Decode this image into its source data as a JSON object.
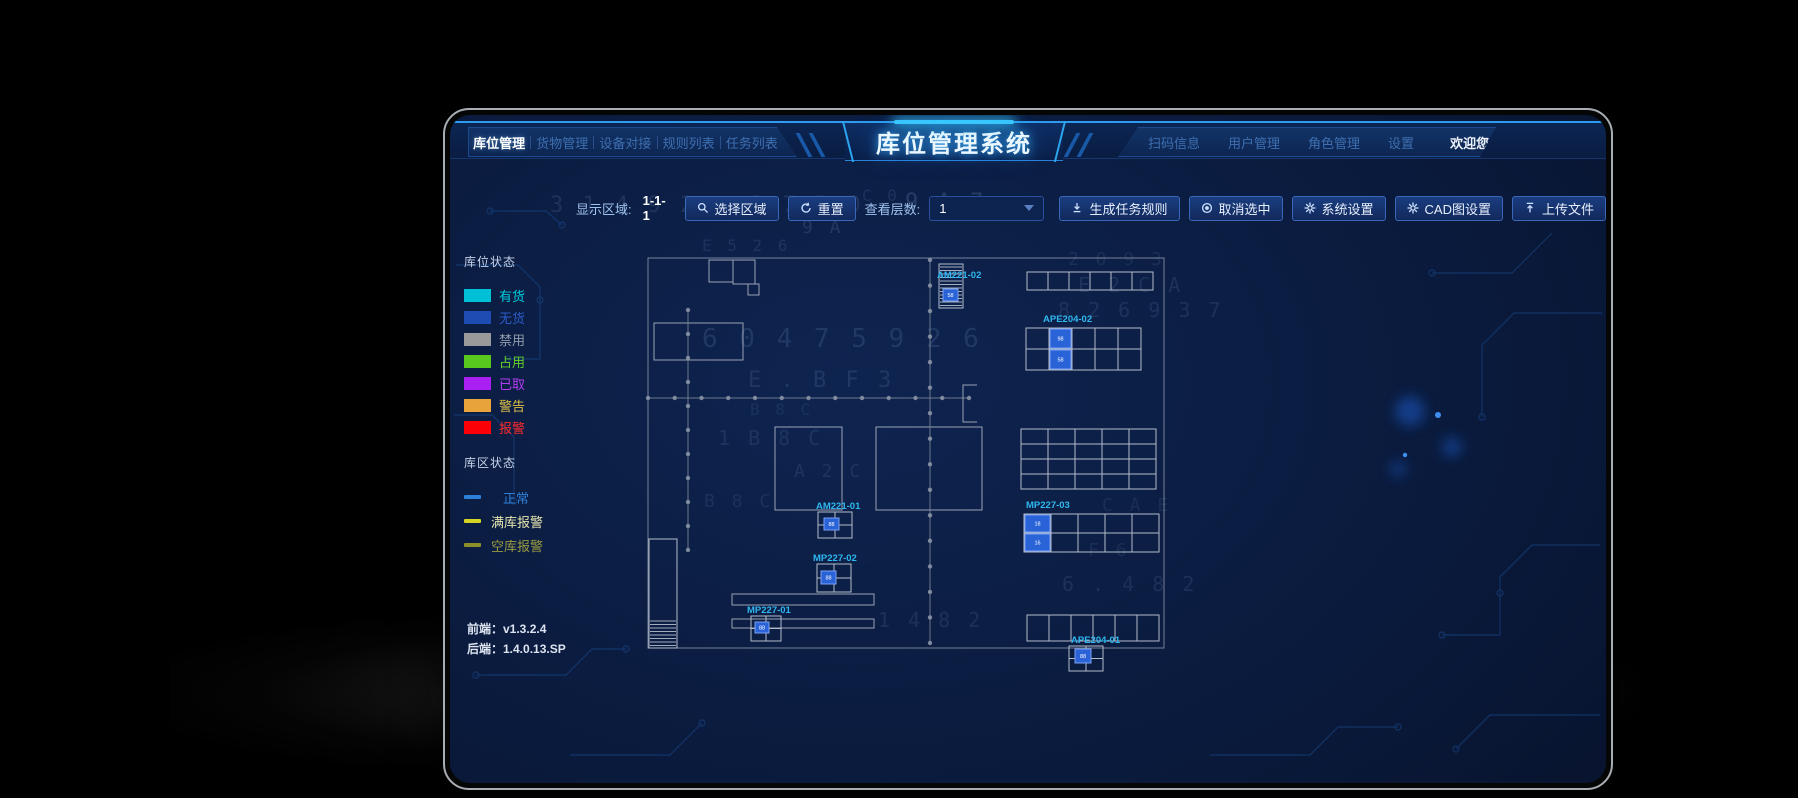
{
  "title": "库位管理系统",
  "nav": {
    "left": [
      {
        "label": "库位管理"
      },
      {
        "label": "货物管理"
      },
      {
        "label": "设备对接"
      },
      {
        "label": "规则列表"
      },
      {
        "label": "任务列表"
      }
    ],
    "right": [
      {
        "label": "扫码信息"
      },
      {
        "label": "用户管理"
      },
      {
        "label": "角色管理"
      },
      {
        "label": "设置"
      }
    ],
    "welcome": "欢迎您，super"
  },
  "toolbar": {
    "area_label": "显示区域:",
    "area_value": "1-1-1",
    "select_area": "选择区域",
    "reset": "重置",
    "layers_label": "查看层数:",
    "layers_value": "1",
    "generate": "生成任务规则",
    "cancel_selected": "取消选中",
    "system_settings": "系统设置",
    "cad_settings": "CAD图设置",
    "upload": "上传文件"
  },
  "legend": {
    "slot_title": "库位状态",
    "slot_items": [
      {
        "label": "有货",
        "color": "#00c0d8",
        "text_color": "#00cfe0"
      },
      {
        "label": "无货",
        "color": "#1d4db2",
        "text_color": "#2a5cc8"
      },
      {
        "label": "禁用",
        "color": "#9a9a9a",
        "text_color": "#949cac"
      },
      {
        "label": "占用",
        "color": "#58c81e",
        "text_color": "#62d02a"
      },
      {
        "label": "已取",
        "color": "#aa1ff2",
        "text_color": "#b43cf5"
      },
      {
        "label": "警告",
        "color": "#e8a33a",
        "text_color": "#e0c045"
      },
      {
        "label": "报警",
        "color": "#fb0007",
        "text_color": "#ff2a2a"
      }
    ],
    "zone_title": "库区状态",
    "zone_items": [
      {
        "label": "正常",
        "color": "#2e7fd8",
        "text_color": "#2e7fd8"
      },
      {
        "label": "满库报警",
        "color": "#d4d422",
        "text_color": "#e6e6b0"
      },
      {
        "label": "空库报警",
        "color": "#8f8f2a",
        "text_color": "#9a9a40"
      }
    ]
  },
  "footer": {
    "frontend": "前端：v1.3.2.4",
    "backend": "后端：1.4.0.13.SP"
  },
  "map": {
    "line_color": "#9aa3b5",
    "grid_color": "#b4bccb",
    "label_color": "#2fb8f0",
    "cell_color": "#2a63d8",
    "cell_border": "#7aa2f2",
    "outer": [
      198,
      143,
      516,
      390
    ],
    "rooms": [
      [
        259,
        145,
        24,
        22
      ],
      [
        283,
        145,
        22,
        24
      ],
      [
        298,
        169,
        11,
        11
      ],
      [
        204,
        208,
        89,
        37
      ],
      [
        325,
        312,
        67,
        83
      ],
      [
        426,
        312,
        106,
        83
      ],
      [
        282,
        479,
        142,
        11
      ],
      [
        282,
        504,
        142,
        9
      ]
    ],
    "grids": [
      {
        "x": 577,
        "y": 157,
        "cols": 6,
        "rows": 1,
        "cw": 21,
        "ch": 18
      },
      {
        "x": 576,
        "y": 213,
        "cols": 5,
        "rows": 2,
        "cw": 23,
        "ch": 21,
        "label": "APE204-02",
        "lx": 593,
        "ly": 207,
        "blue": [
          [
            1,
            0,
            "98"
          ],
          [
            1,
            1,
            "58"
          ]
        ]
      },
      {
        "x": 571,
        "y": 314,
        "cols": 5,
        "rows": 4,
        "cw": 27,
        "ch": 15
      },
      {
        "x": 574,
        "y": 399,
        "cols": 5,
        "rows": 2,
        "cw": 27,
        "ch": 19,
        "label": "MP227-03",
        "lx": 576,
        "ly": 393,
        "blue": [
          [
            0,
            0,
            "18"
          ],
          [
            0,
            1,
            "16"
          ]
        ]
      },
      {
        "x": 577,
        "y": 500,
        "cols": 6,
        "rows": 1,
        "cw": 22,
        "ch": 26
      }
    ],
    "striped_racks": [
      {
        "x": 489,
        "y": 149,
        "w": 24,
        "h": 44,
        "label": "AM221-02",
        "lx": 487,
        "ly": 163,
        "cell": [
          493,
          174,
          15,
          12,
          "58"
        ]
      },
      {
        "x": 199,
        "y": 424,
        "w": 28,
        "h": 109,
        "hatch_from": 82
      }
    ],
    "mini_racks": [
      {
        "x": 368,
        "y": 397,
        "w": 34,
        "h": 26,
        "label": "AM221-01",
        "lx": 366,
        "ly": 394,
        "cell": [
          374,
          403,
          15,
          12,
          "88"
        ]
      },
      {
        "x": 367,
        "y": 449,
        "w": 34,
        "h": 28,
        "label": "MP227-02",
        "lx": 363,
        "ly": 446,
        "cell": [
          371,
          456,
          15,
          13,
          "88"
        ]
      },
      {
        "x": 301,
        "y": 501,
        "w": 30,
        "h": 25,
        "label": "MP227-01",
        "lx": 297,
        "ly": 498,
        "cell": [
          305,
          507,
          14,
          11,
          "88"
        ]
      },
      {
        "x": 619,
        "y": 531,
        "w": 34,
        "h": 25,
        "label": "APE204-01",
        "lx": 621,
        "ly": 528,
        "cell": [
          625,
          534,
          16,
          14,
          "88"
        ]
      }
    ],
    "conveyors": [
      {
        "x1": 238,
        "y1": 195,
        "x2": 238,
        "y2": 435,
        "step": 24
      },
      {
        "x1": 198,
        "y1": 283,
        "x2": 519,
        "y2": 283,
        "step": 26
      },
      {
        "x1": 480,
        "y1": 145,
        "x2": 480,
        "y2": 528,
        "step": 24
      }
    ],
    "bracket": "M527,270 h-14 v37 h14"
  },
  "bg_glyphs": [
    {
      "t": "3 1 4 9 2",
      "x": 100,
      "y": 97,
      "s": 22,
      "o": 0.13
    },
    {
      "t": "3 7 5 0",
      "x": 300,
      "y": 97,
      "s": 22,
      "o": 0.13
    },
    {
      "t": "9 A 7",
      "x": 455,
      "y": 94,
      "s": 22,
      "o": 0.18
    },
    {
      "t": "C 0",
      "x": 412,
      "y": 86,
      "s": 16,
      "o": 0.12
    },
    {
      "t": "E 5 2 6",
      "x": 252,
      "y": 136,
      "s": 16,
      "o": 0.12
    },
    {
      "t": "9 A",
      "x": 352,
      "y": 118,
      "s": 18,
      "o": 0.15
    },
    {
      "t": "6 0 4 7  5 9 2 6",
      "x": 252,
      "y": 232,
      "s": 26,
      "o": 0.14
    },
    {
      "t": "E . B F 3",
      "x": 298,
      "y": 272,
      "s": 22,
      "o": 0.13
    },
    {
      "t": "1  B 8  C",
      "x": 268,
      "y": 330,
      "s": 20,
      "o": 0.12
    },
    {
      "t": "A 2  C",
      "x": 344,
      "y": 362,
      "s": 18,
      "o": 0.12
    },
    {
      "t": "B 8  C",
      "x": 254,
      "y": 392,
      "s": 18,
      "o": 0.11
    },
    {
      "t": "2 0 9 3",
      "x": 618,
      "y": 150,
      "s": 18,
      "o": 0.1
    },
    {
      "t": "E 2 C  A",
      "x": 628,
      "y": 177,
      "s": 20,
      "o": 0.12
    },
    {
      "t": "8 2 6 9 3 7",
      "x": 608,
      "y": 202,
      "s": 20,
      "o": 0.12
    },
    {
      "t": "C A E",
      "x": 652,
      "y": 396,
      "s": 18,
      "o": 0.1
    },
    {
      "t": "F  6",
      "x": 638,
      "y": 441,
      "s": 18,
      "o": 0.1
    },
    {
      "t": "6 . 4 8 2",
      "x": 612,
      "y": 476,
      "s": 20,
      "o": 0.12
    },
    {
      "t": "1 4 8 2",
      "x": 428,
      "y": 512,
      "s": 20,
      "o": 0.12
    },
    {
      "t": "B 8  C",
      "x": 300,
      "y": 300,
      "s": 16,
      "o": 0.1
    }
  ]
}
